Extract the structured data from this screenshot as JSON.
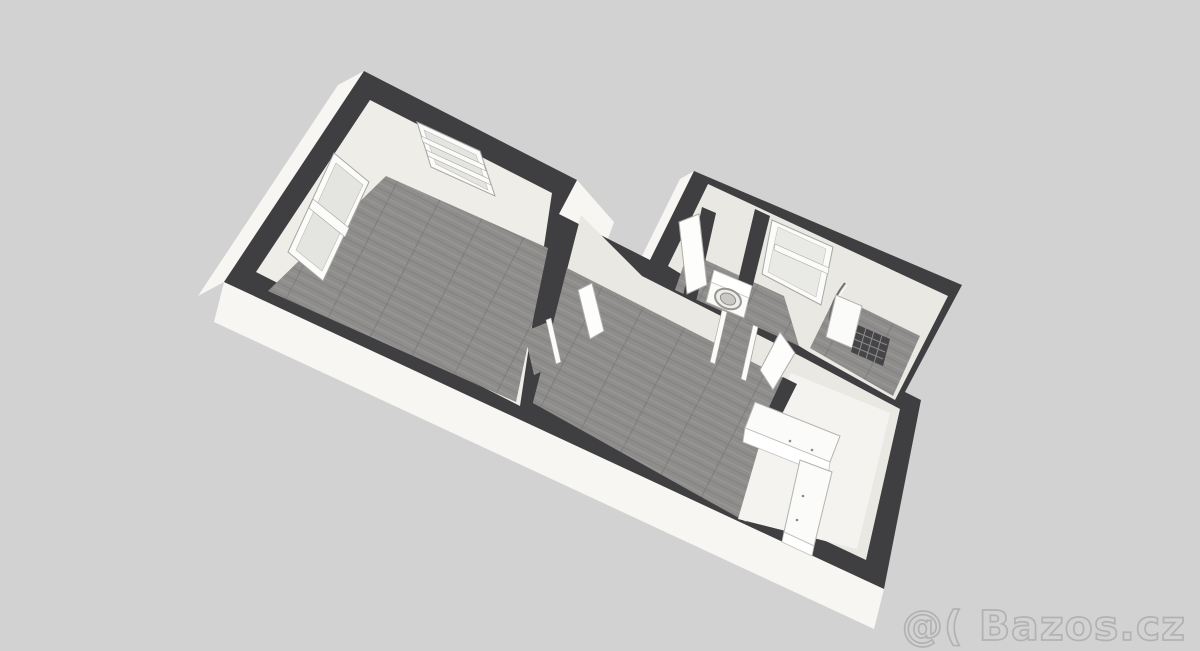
{
  "watermark": {
    "text": "@( Bazos.cz"
  },
  "colors": {
    "background": "#d2d2d2",
    "wall_top": "#3f3f41",
    "wall_exterior_face": "#f7f6f3",
    "wall_interior_face": "#eae8e2",
    "floor_wood": "#8e8d8b",
    "floor_light": "#f4f3f0",
    "fixture_white": "#fbfbfa",
    "watermark_stroke": "#b2b2b2"
  },
  "scene": {
    "view": "3d-floorplan-perspective",
    "rooms": [
      "room-top-left-with-two-windows",
      "living-room-center",
      "hallway-back",
      "laundry-nook-with-washing-machine",
      "bathroom-with-shower-and-window",
      "kitchen-corner-with-l-counter"
    ],
    "fixtures": [
      "window-left-wall",
      "window-back-wall",
      "window-bathroom-blind",
      "washing-machine",
      "shower-enclosure-curved",
      "radiator-grid",
      "kitchen-counter-l-shape",
      "interior-open-doors"
    ]
  }
}
